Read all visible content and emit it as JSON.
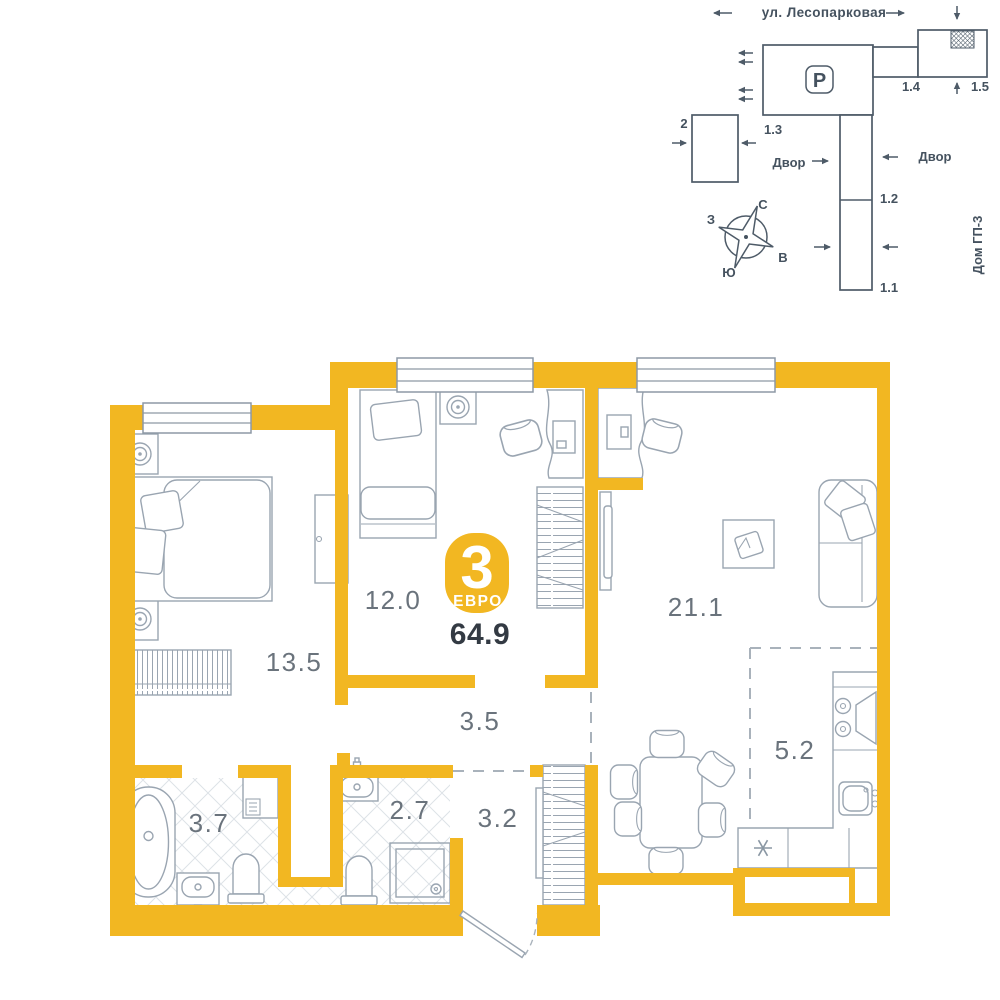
{
  "site_plan": {
    "street_name": "ул. Лесопарковая",
    "parking_label": "P",
    "yard_label_left": "Двор",
    "yard_label_right": "Двор",
    "house_label": "Дом ГП-3",
    "building_labels": {
      "b1_1": "1.1",
      "b1_2": "1.2",
      "b1_3": "1.3",
      "b1_4": "1.4",
      "b1_5": "1.5",
      "b2": "2"
    },
    "compass": {
      "north": "С",
      "south": "Ю",
      "west": "З",
      "east": "В"
    }
  },
  "apartment": {
    "badge_rooms": "3",
    "badge_type": "ЕВРО",
    "total_area": "64.9",
    "rooms": {
      "bedroom1": "13.5",
      "bedroom2": "12.0",
      "corridor": "3.5",
      "living": "21.1",
      "kitchen": "5.2",
      "bathroom": "3.7",
      "wc": "2.7",
      "hall": "3.2"
    }
  },
  "colors": {
    "wall": "#F2B722",
    "furniture_line": "#9AA5B1",
    "site_line": "#4E5B68",
    "text_dark": "#333A43"
  }
}
